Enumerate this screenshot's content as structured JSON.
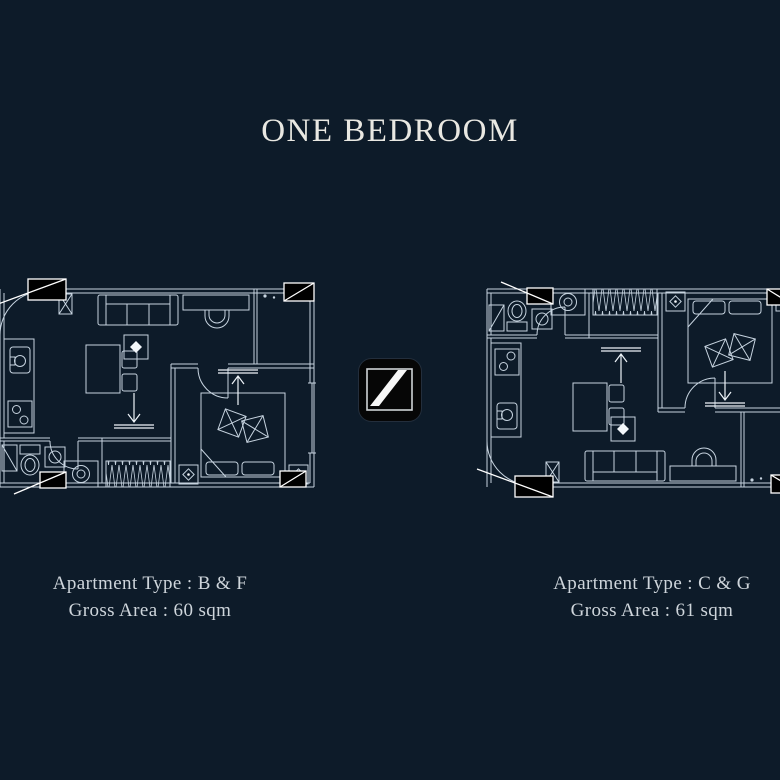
{
  "page": {
    "title": "ONE BEDROOM",
    "background_color": "#0d1b29",
    "line_color": "#c6d3df",
    "title_color": "#e9e8e2"
  },
  "logo": {
    "symbol": "diagonal-slash",
    "background_color": "#060606",
    "slash_color": "#f7f7f7"
  },
  "plans": [
    {
      "position": "left",
      "apartment_type_label": "Apartment Type : B & F",
      "gross_area_label": "Gross Area : 60 sqm",
      "features": [
        "entry-door",
        "sofa",
        "coffee-table",
        "desk-and-chair",
        "dining-table",
        "kitchen-sink",
        "kitchen-stove",
        "bathroom-toilet",
        "bathroom-sink",
        "shower",
        "wardrobe",
        "washing-machine",
        "bed",
        "nightstands",
        "entry-arrows",
        "section-markers"
      ]
    },
    {
      "position": "right",
      "apartment_type_label": "Apartment Type : C & G",
      "gross_area_label": "Gross Area : 61 sqm",
      "features": [
        "entry-door",
        "sofa",
        "coffee-table",
        "desk-and-chair",
        "dining-table",
        "kitchen-sink",
        "kitchen-stove",
        "bathroom-toilet",
        "bathroom-sink",
        "shower",
        "wardrobe",
        "washing-machine",
        "bed",
        "nightstands",
        "entry-arrows",
        "section-markers"
      ]
    }
  ]
}
